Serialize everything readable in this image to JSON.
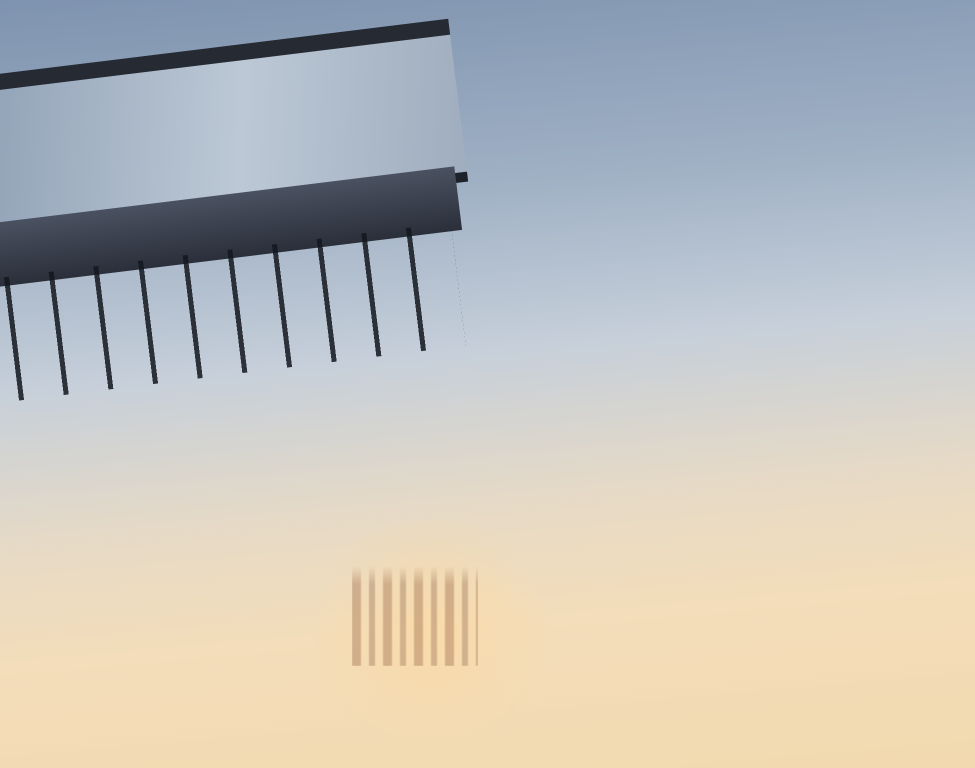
{
  "logo": {
    "brand": "ОСТРОВ."
  },
  "plan": {
    "rooms": [
      {
        "name": "спальня",
        "area": "12,7"
      },
      {
        "name": "спальня",
        "area": "12,3"
      },
      {
        "name": "кухня-гостиная",
        "area": "31,4"
      },
      {
        "name": "спальня",
        "area": "18,4"
      },
      {
        "name": "с/у",
        "area": "6,6"
      },
      {
        "name": "с/у",
        "area": "4,4"
      },
      {
        "name": "гард.",
        "area": "4,6"
      },
      {
        "name": "коридор",
        "area": "9,7"
      },
      {
        "name": "терраса",
        "area": "13,0 (3,9)"
      }
    ]
  },
  "stats": [
    {
      "value": "104",
      "label": "ПЛОЩАДЬ"
    },
    {
      "value": "14",
      "label": "ЭТАЖ"
    },
    {
      "value": "3",
      "label": "КОМНАТ"
    }
  ],
  "colors": {
    "wall_navy": "#3e3b74",
    "stat_number": "#454180",
    "stat_label": "#232327",
    "card_bg": "#edeff3"
  }
}
